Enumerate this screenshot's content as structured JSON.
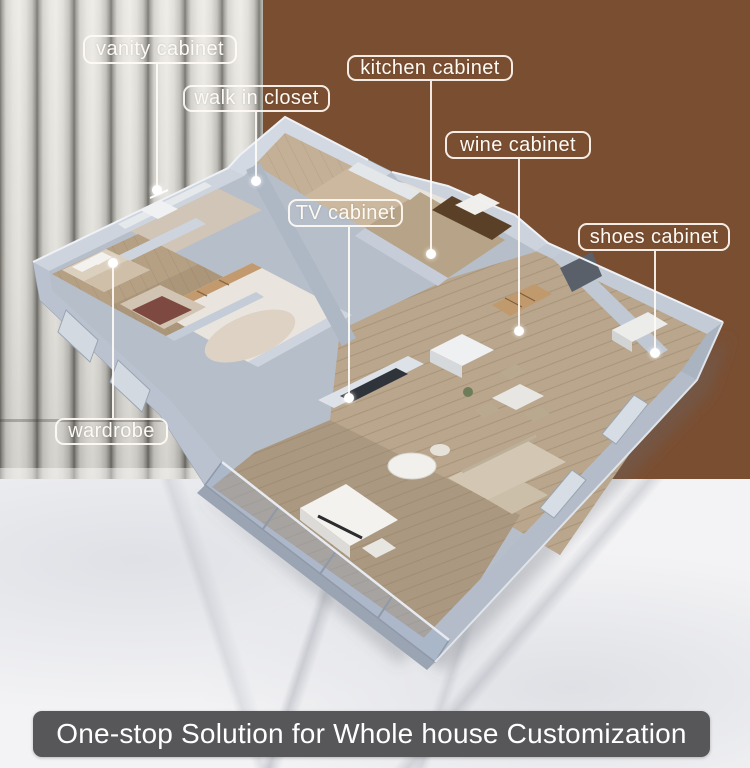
{
  "poster": {
    "type": "isometric-floorplan-advertisement",
    "banner": {
      "text": "One-stop Solution for Whole house Customization"
    }
  },
  "callouts": {
    "vanity": {
      "label": "vanity cabinet"
    },
    "closet": {
      "label": "walk in closet"
    },
    "kitchen": {
      "label": "kitchen cabinet"
    },
    "wine": {
      "label": "wine cabinet"
    },
    "tv": {
      "label": "TV cabinet"
    },
    "shoes": {
      "label": "shoes cabinet"
    },
    "wardrobe": {
      "label": "wardrobe"
    }
  },
  "scene": {
    "furniture": [
      "bed",
      "bed",
      "vanity",
      "wardrobe-shelves",
      "rug",
      "kitchen-counter",
      "kitchen-island",
      "wine-shelf",
      "dining-table",
      "dining-chairs",
      "sofa",
      "coffee-table",
      "tv-unit",
      "piano",
      "shoes-cabinet",
      "balcony-glass"
    ],
    "colors": {
      "wall_top": "#ccd3dd",
      "wall_mid": "#b6beca",
      "wall_dark": "#98a2b0",
      "floor_wood": "#b7a186",
      "floor_rug": "#e9e5de",
      "cabinet_dark_wood": "#5a4026",
      "shelf_wood": "#c29a6e",
      "background_wood": "#7a4e31",
      "background_panel": "#d7d5cf",
      "background_marble": "#f3f3f5",
      "banner_bg": "#57575a",
      "label_line": "#fdfaf3"
    }
  }
}
